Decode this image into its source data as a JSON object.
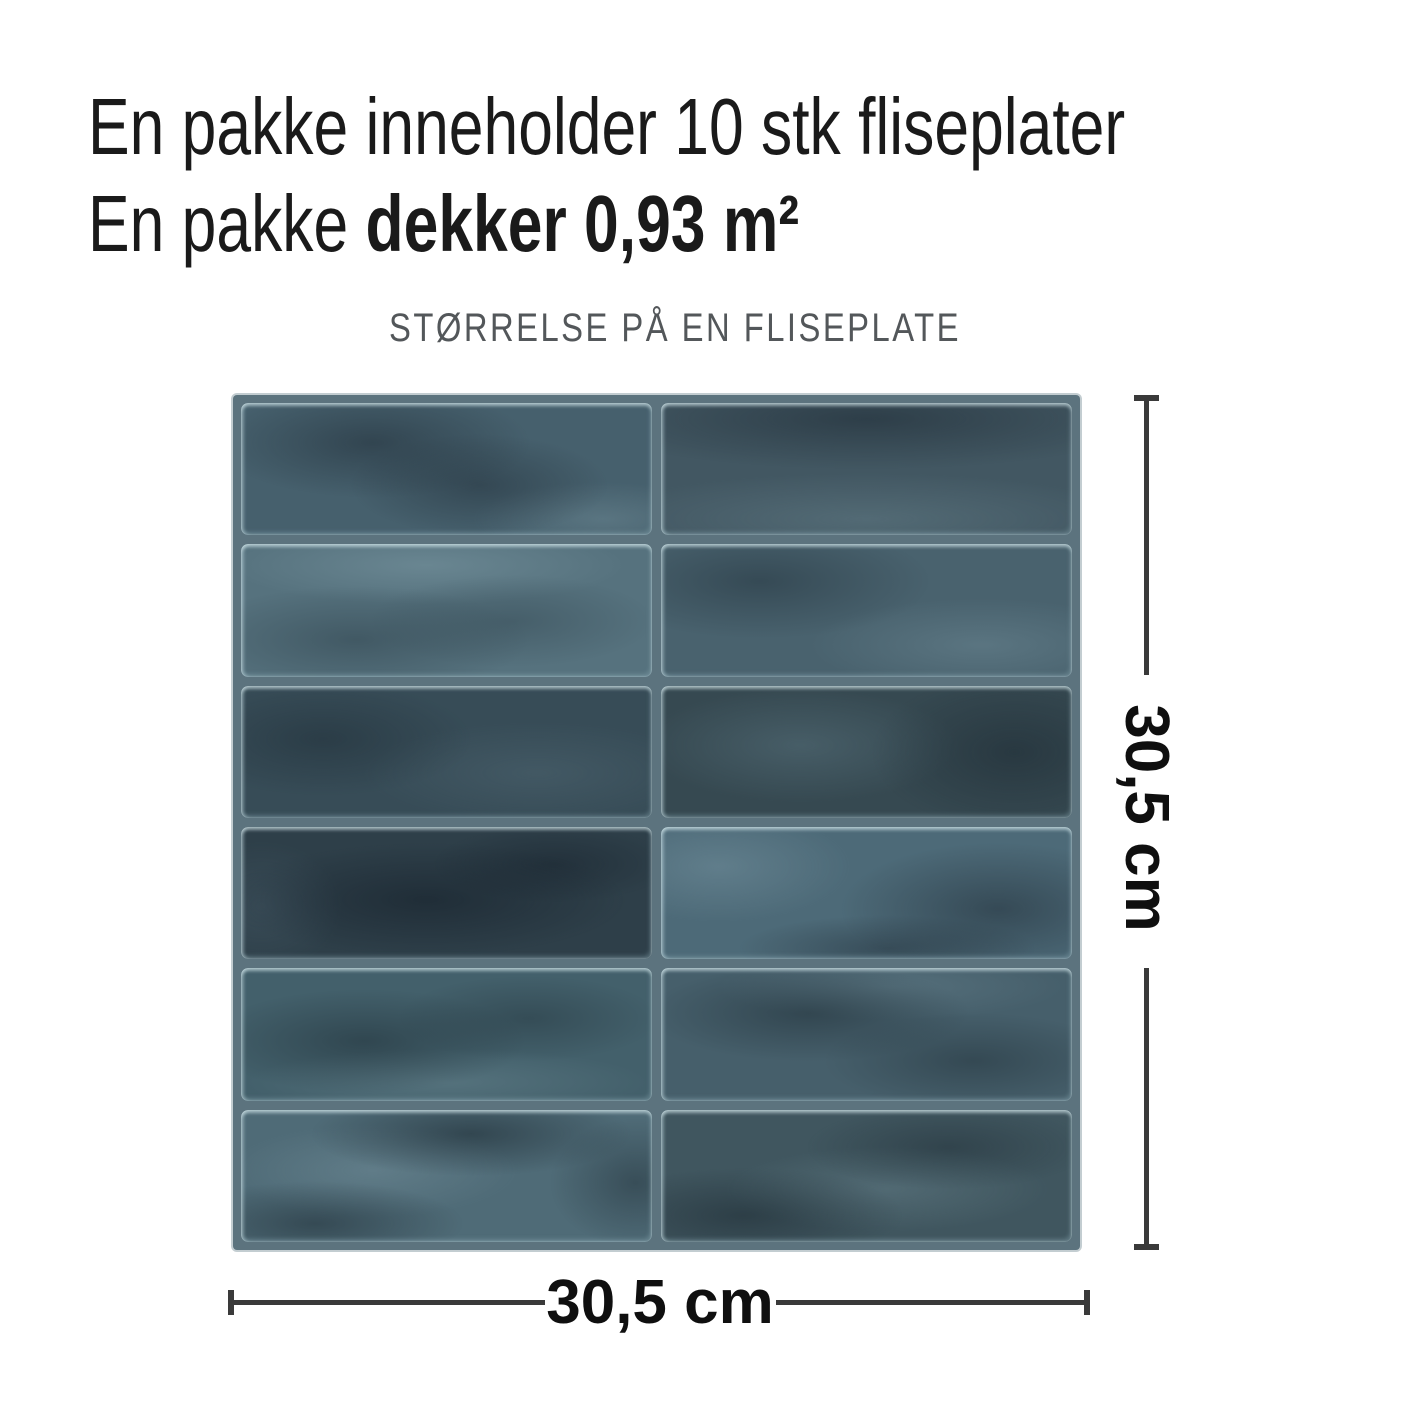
{
  "heading": {
    "line1": "En pakke inneholder 10 stk fliseplater",
    "line2_regular": "En pakke ",
    "line2_bold": "dekker 0,93 m²"
  },
  "subtitle": "STØRRELSE PÅ EN FLISEPLATE",
  "dimensions": {
    "height_label": "30,5 cm",
    "width_label": "30,5 cm"
  },
  "colors": {
    "heading_text": "#1a1a1a",
    "subtitle_text": "#53575a",
    "grout": "#5c737e",
    "dim_line": "#3a3a3a",
    "label_text": "#0f0f0f"
  },
  "panel": {
    "rows": 6,
    "cols": 2,
    "tiles": [
      {
        "base": "#46606d",
        "spots": [
          {
            "x": 32,
            "y": 30,
            "w": 55,
            "h": 60,
            "c": "rgba(30,42,52,0.50)"
          },
          {
            "x": 58,
            "y": 62,
            "w": 45,
            "h": 55,
            "c": "rgba(30,42,52,0.45)"
          },
          {
            "x": 88,
            "y": 88,
            "w": 45,
            "h": 40,
            "c": "rgba(140,170,180,0.28)"
          }
        ]
      },
      {
        "base": "#425762",
        "spots": [
          {
            "x": 50,
            "y": 12,
            "w": 100,
            "h": 55,
            "c": "rgba(26,38,48,0.50)"
          },
          {
            "x": 50,
            "y": 88,
            "w": 95,
            "h": 50,
            "c": "rgba(120,150,160,0.30)"
          }
        ]
      },
      {
        "base": "#56727e",
        "spots": [
          {
            "x": 28,
            "y": 72,
            "w": 60,
            "h": 58,
            "c": "rgba(40,58,68,0.45)"
          },
          {
            "x": 66,
            "y": 58,
            "w": 50,
            "h": 50,
            "c": "rgba(40,58,68,0.35)"
          },
          {
            "x": 45,
            "y": 16,
            "w": 70,
            "h": 42,
            "c": "rgba(150,180,190,0.30)"
          }
        ]
      },
      {
        "base": "#49626e",
        "spots": [
          {
            "x": 24,
            "y": 28,
            "w": 60,
            "h": 62,
            "c": "rgba(30,45,55,0.45)"
          },
          {
            "x": 78,
            "y": 76,
            "w": 60,
            "h": 50,
            "c": "rgba(130,160,172,0.30)"
          }
        ]
      },
      {
        "base": "#374c57",
        "spots": [
          {
            "x": 20,
            "y": 40,
            "w": 52,
            "h": 62,
            "c": "rgba(25,38,47,0.40)"
          },
          {
            "x": 72,
            "y": 66,
            "w": 60,
            "h": 55,
            "c": "rgba(95,120,132,0.28)"
          }
        ]
      },
      {
        "base": "#364951",
        "spots": [
          {
            "x": 86,
            "y": 50,
            "w": 50,
            "h": 85,
            "c": "rgba(24,36,45,0.45)"
          },
          {
            "x": 34,
            "y": 45,
            "w": 55,
            "h": 62,
            "c": "rgba(105,135,148,0.33)"
          }
        ]
      },
      {
        "base": "#2e3f49",
        "spots": [
          {
            "x": 45,
            "y": 55,
            "w": 70,
            "h": 62,
            "c": "rgba(18,28,38,0.50)"
          },
          {
            "x": 76,
            "y": 28,
            "w": 42,
            "h": 42,
            "c": "rgba(18,28,38,0.40)"
          },
          {
            "x": 5,
            "y": 60,
            "w": 28,
            "h": 70,
            "c": "rgba(90,115,130,0.25)"
          }
        ]
      },
      {
        "base": "#4d6a78",
        "spots": [
          {
            "x": 82,
            "y": 62,
            "w": 55,
            "h": 72,
            "c": "rgba(30,42,52,0.50)"
          },
          {
            "x": 55,
            "y": 92,
            "w": 52,
            "h": 36,
            "c": "rgba(30,42,52,0.45)"
          },
          {
            "x": 14,
            "y": 30,
            "w": 46,
            "h": 60,
            "c": "rgba(140,170,182,0.30)"
          }
        ]
      },
      {
        "base": "#43606b",
        "spots": [
          {
            "x": 30,
            "y": 55,
            "w": 56,
            "h": 56,
            "c": "rgba(26,40,48,0.45)"
          },
          {
            "x": 70,
            "y": 38,
            "w": 46,
            "h": 46,
            "c": "rgba(26,40,48,0.35)"
          },
          {
            "x": 50,
            "y": 86,
            "w": 70,
            "h": 36,
            "c": "rgba(130,160,170,0.28)"
          }
        ]
      },
      {
        "base": "#465f6b",
        "spots": [
          {
            "x": 36,
            "y": 34,
            "w": 56,
            "h": 52,
            "c": "rgba(26,40,48,0.45)"
          },
          {
            "x": 76,
            "y": 70,
            "w": 52,
            "h": 52,
            "c": "rgba(26,40,48,0.40)"
          },
          {
            "x": 56,
            "y": 14,
            "w": 60,
            "h": 36,
            "c": "rgba(130,160,172,0.25)"
          }
        ]
      },
      {
        "base": "#4f6b77",
        "spots": [
          {
            "x": 56,
            "y": 18,
            "w": 56,
            "h": 46,
            "c": "rgba(22,34,42,0.50)"
          },
          {
            "x": 18,
            "y": 86,
            "w": 52,
            "h": 46,
            "c": "rgba(22,34,42,0.45)"
          },
          {
            "x": 96,
            "y": 55,
            "w": 30,
            "h": 70,
            "c": "rgba(22,34,42,0.40)"
          },
          {
            "x": 32,
            "y": 46,
            "w": 50,
            "h": 50,
            "c": "rgba(140,168,180,0.28)"
          }
        ]
      },
      {
        "base": "#40565f",
        "spots": [
          {
            "x": 20,
            "y": 80,
            "w": 56,
            "h": 52,
            "c": "rgba(22,34,42,0.45)"
          },
          {
            "x": 70,
            "y": 28,
            "w": 50,
            "h": 46,
            "c": "rgba(22,34,42,0.35)"
          },
          {
            "x": 55,
            "y": 60,
            "w": 56,
            "h": 46,
            "c": "rgba(120,150,160,0.30)"
          }
        ]
      }
    ]
  }
}
